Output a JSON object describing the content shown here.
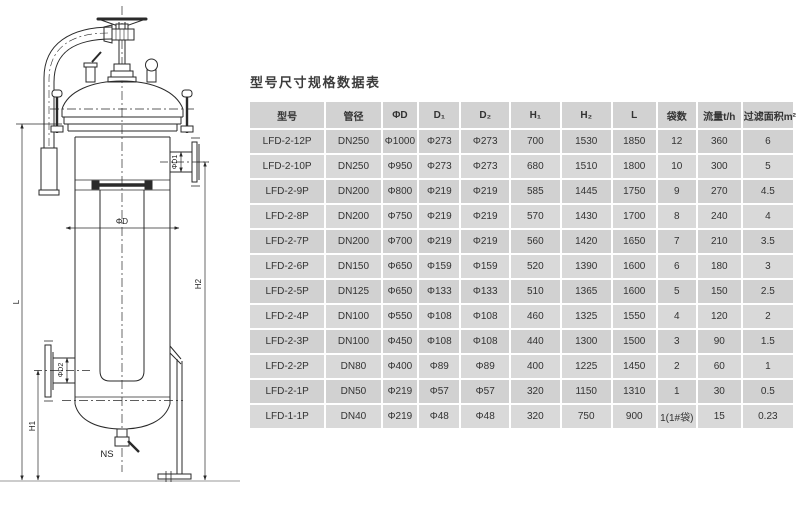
{
  "table": {
    "title": "型号尺寸规格数据表",
    "headers": [
      "型号",
      "管径",
      "ΦD",
      "D₁",
      "D₂",
      "H₁",
      "H₂",
      "L",
      "袋数",
      "流量t/h",
      "过滤面积m²"
    ],
    "rows": [
      [
        "LFD-2-12P",
        "DN250",
        "Φ1000",
        "Φ273",
        "Φ273",
        "700",
        "1530",
        "1850",
        "12",
        "360",
        "6"
      ],
      [
        "LFD-2-10P",
        "DN250",
        "Φ950",
        "Φ273",
        "Φ273",
        "680",
        "1510",
        "1800",
        "10",
        "300",
        "5"
      ],
      [
        "LFD-2-9P",
        "DN200",
        "Φ800",
        "Φ219",
        "Φ219",
        "585",
        "1445",
        "1750",
        "9",
        "270",
        "4.5"
      ],
      [
        "LFD-2-8P",
        "DN200",
        "Φ750",
        "Φ219",
        "Φ219",
        "570",
        "1430",
        "1700",
        "8",
        "240",
        "4"
      ],
      [
        "LFD-2-7P",
        "DN200",
        "Φ700",
        "Φ219",
        "Φ219",
        "560",
        "1420",
        "1650",
        "7",
        "210",
        "3.5"
      ],
      [
        "LFD-2-6P",
        "DN150",
        "Φ650",
        "Φ159",
        "Φ159",
        "520",
        "1390",
        "1600",
        "6",
        "180",
        "3"
      ],
      [
        "LFD-2-5P",
        "DN125",
        "Φ650",
        "Φ133",
        "Φ133",
        "510",
        "1365",
        "1600",
        "5",
        "150",
        "2.5"
      ],
      [
        "LFD-2-4P",
        "DN100",
        "Φ550",
        "Φ108",
        "Φ108",
        "460",
        "1325",
        "1550",
        "4",
        "120",
        "2"
      ],
      [
        "LFD-2-3P",
        "DN100",
        "Φ450",
        "Φ108",
        "Φ108",
        "440",
        "1300",
        "1500",
        "3",
        "90",
        "1.5"
      ],
      [
        "LFD-2-2P",
        "DN80",
        "Φ400",
        "Φ89",
        "Φ89",
        "400",
        "1225",
        "1450",
        "2",
        "60",
        "1"
      ],
      [
        "LFD-2-1P",
        "DN50",
        "Φ219",
        "Φ57",
        "Φ57",
        "320",
        "1150",
        "1310",
        "1",
        "30",
        "0.5"
      ],
      [
        "LFD-1-1P",
        "DN40",
        "Φ219",
        "Φ48",
        "Φ48",
        "320",
        "750",
        "900",
        "1(1#袋)",
        "15",
        "0.23"
      ]
    ],
    "colors": {
      "header_bg": "#d2d2d2",
      "row_odd": "#d1d1d1",
      "row_even": "#d9d9d9",
      "grid": "#ffffff",
      "text": "#333333"
    }
  },
  "drawing": {
    "labels": {
      "shell_diameter": "ΦD",
      "inlet_diameter": "ΦD1",
      "outlet_diameter": "ΦD2",
      "height_h1": "H1",
      "height_h2": "H2",
      "total_length": "L",
      "drain": "NS"
    },
    "line_color": "#2a2a2a"
  }
}
